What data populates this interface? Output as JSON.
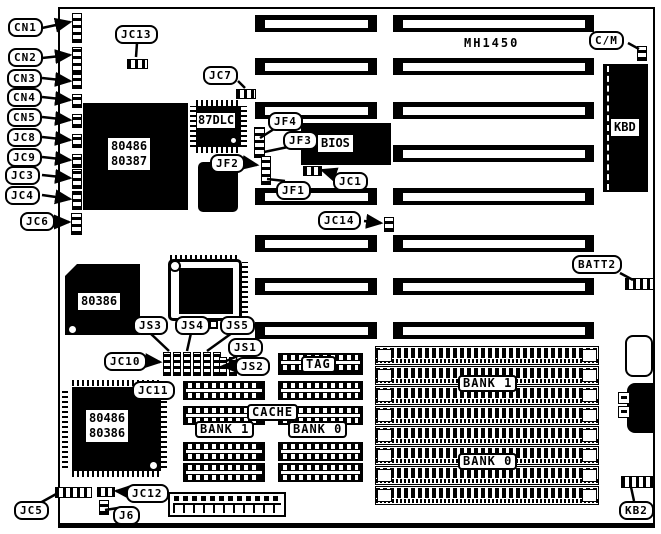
{
  "board": {
    "model": "MH1450"
  },
  "chips": {
    "cpu_socket_top": {
      "line1": "80486",
      "line2": "80387"
    },
    "coprocessor": "87DLC",
    "bios": "BIOS",
    "keyboard_controller": "KBD",
    "chip_80386": "80386",
    "cpu_socket_bottom": {
      "line1": "80486",
      "line2": "80386"
    }
  },
  "memory": {
    "tag": "TAG",
    "cache": "CACHE",
    "cache_bank_1": "BANK 1",
    "cache_bank_0": "BANK 0",
    "simm_bank_1": "BANK 1",
    "simm_bank_0": "BANK 0"
  },
  "callouts": {
    "cn1": "CN1",
    "cn2": "CN2",
    "cn3": "CN3",
    "cn4": "CN4",
    "cn5": "CN5",
    "jc8": "JC8",
    "jc9": "JC9",
    "jc3": "JC3",
    "jc4": "JC4",
    "jc6": "JC6",
    "jc13": "JC13",
    "jc7": "JC7",
    "jf4": "JF4",
    "jf3": "JF3",
    "jf2": "JF2",
    "jf1": "JF1",
    "jc1": "JC1",
    "jc14": "JC14",
    "cm": "C/M",
    "batt2": "BATT2",
    "js3": "JS3",
    "js4": "JS4",
    "js5": "JS5",
    "js1": "JS1",
    "js2": "JS2",
    "jc10": "JC10",
    "jc11": "JC11",
    "jc5": "JC5",
    "jc12": "JC12",
    "j6": "J6",
    "kb2": "KB2"
  },
  "colors": {
    "ink": "#000000",
    "paper": "#ffffff"
  }
}
